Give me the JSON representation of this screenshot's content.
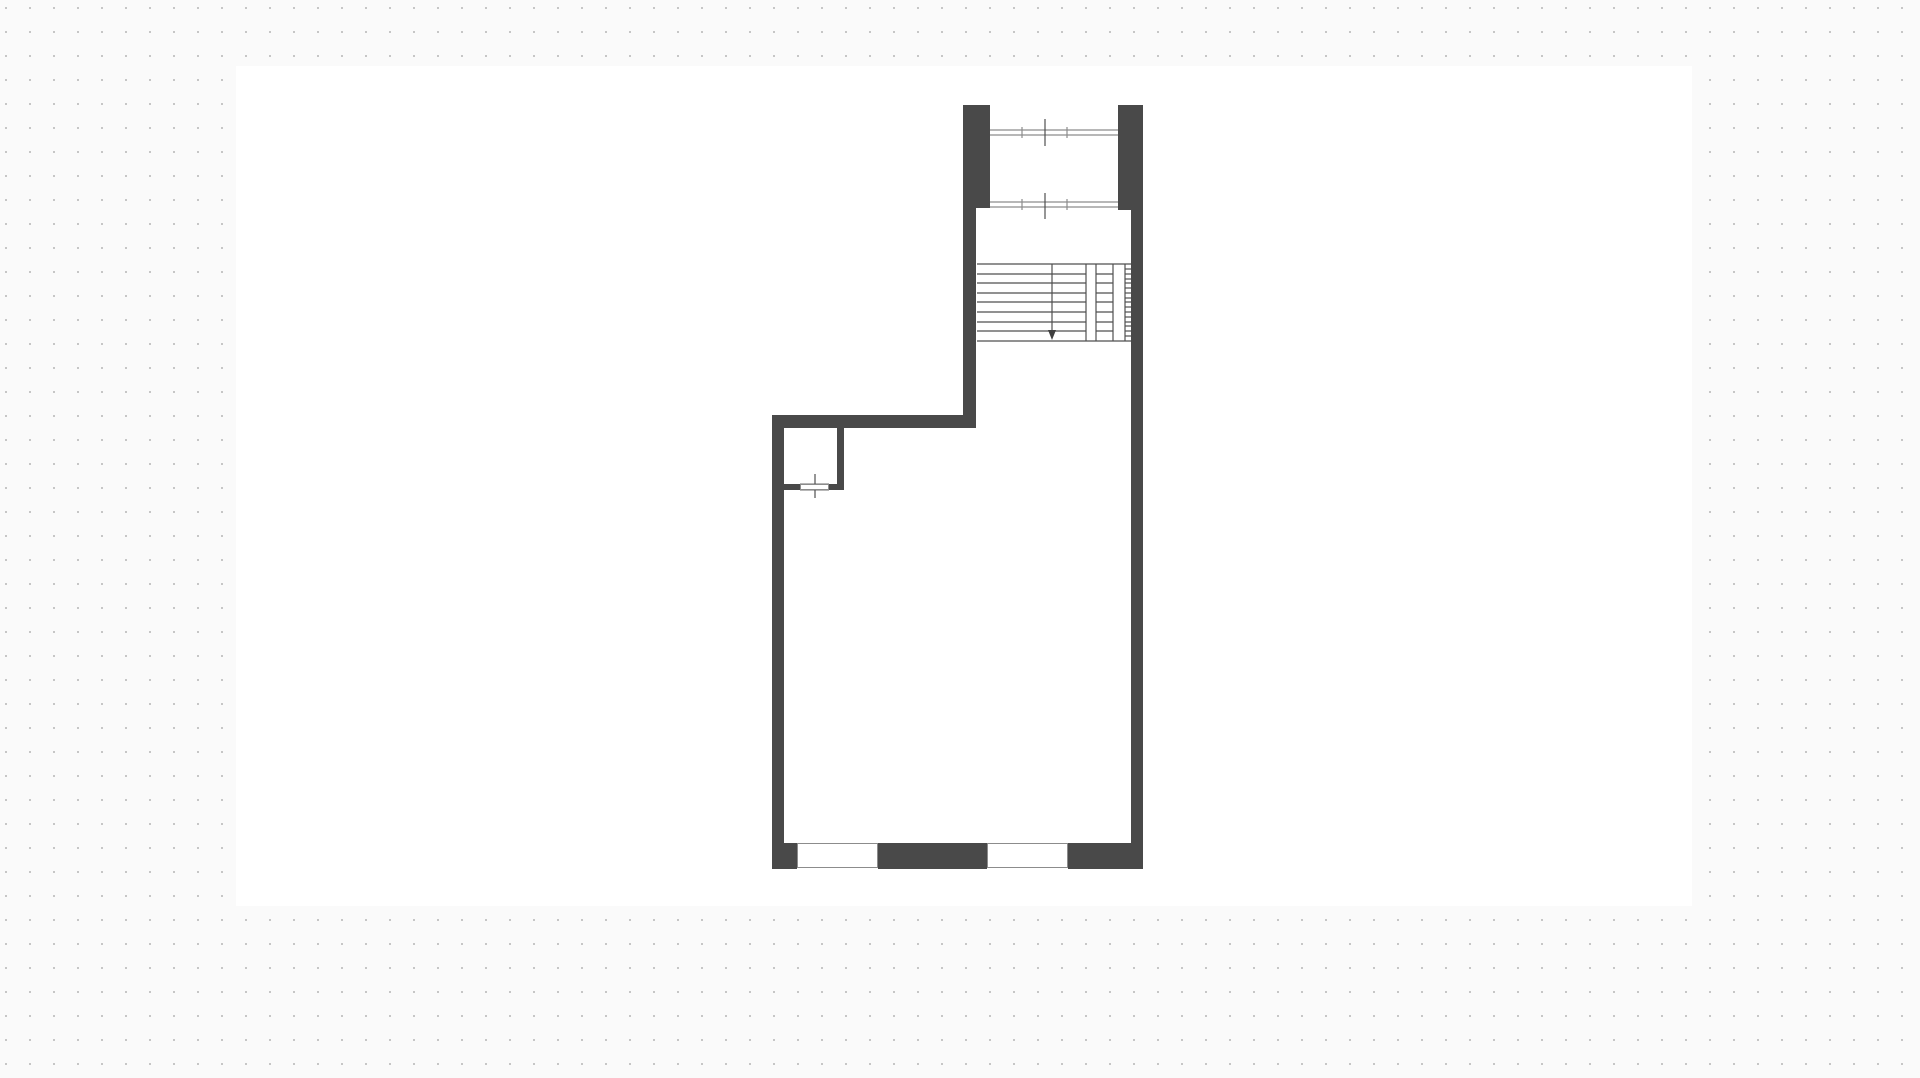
{
  "canvas": {
    "width": 1920,
    "height": 1078,
    "background_color": "#fafafa",
    "grid": {
      "spacing": 24,
      "dot_size": 2,
      "dot_color": "#c6c6c6",
      "offset_x": 5,
      "offset_y": 7
    },
    "artboard": {
      "x": 236,
      "y": 66,
      "width": 1456,
      "height": 840,
      "color": "#ffffff"
    }
  },
  "plan": {
    "colors": {
      "wall": "#494949",
      "line": "#4f4f4f",
      "window_line": "#8c8c8c",
      "window_fill": "#ffffff"
    },
    "walls": [
      {
        "name": "upper-pillar-left",
        "x": 963,
        "y": 105,
        "w": 27,
        "h": 103
      },
      {
        "name": "upper-pillar-right",
        "x": 1118,
        "y": 105,
        "w": 25,
        "h": 105
      },
      {
        "name": "stairwell-left-wall",
        "x": 963,
        "y": 205,
        "w": 13,
        "h": 223
      },
      {
        "name": "right-exterior-wall",
        "x": 1131,
        "y": 205,
        "w": 12,
        "h": 664
      },
      {
        "name": "room-top-wall",
        "x": 772,
        "y": 415,
        "w": 204,
        "h": 13
      },
      {
        "name": "left-exterior-wall",
        "x": 772,
        "y": 415,
        "w": 12,
        "h": 454
      },
      {
        "name": "bottom-wall-left",
        "x": 772,
        "y": 843,
        "w": 25,
        "h": 26
      },
      {
        "name": "bottom-wall-middle",
        "x": 878,
        "y": 843,
        "w": 109,
        "h": 26
      },
      {
        "name": "bottom-wall-right",
        "x": 1068,
        "y": 843,
        "w": 75,
        "h": 26
      },
      {
        "name": "closet-partition-wall",
        "x": 837,
        "y": 427,
        "w": 7,
        "h": 63
      },
      {
        "name": "closet-bottom-wall-a",
        "x": 784,
        "y": 484,
        "w": 16,
        "h": 6
      },
      {
        "name": "closet-bottom-wall-b",
        "x": 829,
        "y": 484,
        "w": 8,
        "h": 6
      }
    ],
    "windows": [
      {
        "name": "bottom-window-left",
        "x": 797,
        "y": 843,
        "w": 81,
        "h": 25
      },
      {
        "name": "bottom-window-right",
        "x": 987,
        "y": 843,
        "w": 81,
        "h": 25
      },
      {
        "name": "closet-door-opening",
        "x": 800,
        "y": 484,
        "w": 29,
        "h": 6
      }
    ],
    "lines": [
      {
        "name": "upper-window-1-line",
        "x1": 990,
        "y1": 130,
        "x2": 1118,
        "y2": 130,
        "color": "#8c8c8c"
      },
      {
        "name": "upper-window-1-line",
        "x1": 990,
        "y1": 135,
        "x2": 1118,
        "y2": 135,
        "color": "#8c8c8c"
      },
      {
        "name": "upper-window-1-mullion",
        "x1": 1022,
        "y1": 127,
        "x2": 1022,
        "y2": 138,
        "color": "#8c8c8c"
      },
      {
        "name": "upper-window-1-mullion",
        "x1": 1067,
        "y1": 127,
        "x2": 1067,
        "y2": 138,
        "color": "#8c8c8c"
      },
      {
        "name": "upper-window-1-center-mark",
        "x1": 1045,
        "y1": 119,
        "x2": 1045,
        "y2": 146,
        "color": "#4f4f4f"
      },
      {
        "name": "upper-window-2-line",
        "x1": 990,
        "y1": 202,
        "x2": 1118,
        "y2": 202,
        "color": "#8c8c8c"
      },
      {
        "name": "upper-window-2-line",
        "x1": 990,
        "y1": 207,
        "x2": 1118,
        "y2": 207,
        "color": "#8c8c8c"
      },
      {
        "name": "upper-window-2-mullion",
        "x1": 1022,
        "y1": 199,
        "x2": 1022,
        "y2": 210,
        "color": "#8c8c8c"
      },
      {
        "name": "upper-window-2-mullion",
        "x1": 1067,
        "y1": 199,
        "x2": 1067,
        "y2": 210,
        "color": "#8c8c8c"
      },
      {
        "name": "upper-window-2-center-mark",
        "x1": 1045,
        "y1": 193,
        "x2": 1045,
        "y2": 219,
        "color": "#4f4f4f"
      },
      {
        "name": "stair-top-edge",
        "x1": 977,
        "y1": 264,
        "x2": 1131,
        "y2": 264,
        "color": "#4f4f4f"
      },
      {
        "name": "stair-bottom-edge",
        "x1": 977,
        "y1": 341,
        "x2": 1131,
        "y2": 341,
        "color": "#4f4f4f"
      },
      {
        "name": "stair-tread",
        "x1": 977,
        "y1": 274,
        "x2": 1086,
        "y2": 274,
        "color": "#4f4f4f"
      },
      {
        "name": "stair-tread",
        "x1": 977,
        "y1": 283,
        "x2": 1086,
        "y2": 283,
        "color": "#4f4f4f"
      },
      {
        "name": "stair-tread",
        "x1": 977,
        "y1": 293,
        "x2": 1086,
        "y2": 293,
        "color": "#4f4f4f"
      },
      {
        "name": "stair-tread",
        "x1": 977,
        "y1": 302,
        "x2": 1086,
        "y2": 302,
        "color": "#4f4f4f"
      },
      {
        "name": "stair-tread",
        "x1": 977,
        "y1": 312,
        "x2": 1086,
        "y2": 312,
        "color": "#4f4f4f"
      },
      {
        "name": "stair-tread",
        "x1": 977,
        "y1": 322,
        "x2": 1086,
        "y2": 322,
        "color": "#4f4f4f"
      },
      {
        "name": "stair-tread",
        "x1": 977,
        "y1": 331,
        "x2": 1086,
        "y2": 331,
        "color": "#4f4f4f"
      },
      {
        "name": "stair-flight-divider",
        "x1": 1086,
        "y1": 264,
        "x2": 1086,
        "y2": 341,
        "color": "#4f4f4f"
      },
      {
        "name": "stair-flight-divider",
        "x1": 1096,
        "y1": 264,
        "x2": 1096,
        "y2": 341,
        "color": "#4f4f4f"
      },
      {
        "name": "stair-flight-divider",
        "x1": 1113,
        "y1": 264,
        "x2": 1113,
        "y2": 341,
        "color": "#4f4f4f"
      },
      {
        "name": "stair-flight-divider",
        "x1": 1125,
        "y1": 264,
        "x2": 1125,
        "y2": 341,
        "color": "#4f4f4f"
      },
      {
        "name": "stair-tread-upper-flight",
        "x1": 1096,
        "y1": 274,
        "x2": 1113,
        "y2": 274,
        "color": "#4f4f4f"
      },
      {
        "name": "stair-tread-upper-flight",
        "x1": 1096,
        "y1": 283,
        "x2": 1113,
        "y2": 283,
        "color": "#4f4f4f"
      },
      {
        "name": "stair-tread-upper-flight",
        "x1": 1096,
        "y1": 293,
        "x2": 1113,
        "y2": 293,
        "color": "#4f4f4f"
      },
      {
        "name": "stair-tread-upper-flight",
        "x1": 1096,
        "y1": 302,
        "x2": 1113,
        "y2": 302,
        "color": "#4f4f4f"
      },
      {
        "name": "stair-tread-upper-flight",
        "x1": 1096,
        "y1": 312,
        "x2": 1113,
        "y2": 312,
        "color": "#4f4f4f"
      },
      {
        "name": "stair-tread-upper-flight",
        "x1": 1096,
        "y1": 322,
        "x2": 1113,
        "y2": 322,
        "color": "#4f4f4f"
      },
      {
        "name": "stair-tread-upper-flight",
        "x1": 1096,
        "y1": 331,
        "x2": 1113,
        "y2": 331,
        "color": "#4f4f4f"
      },
      {
        "name": "stair-tread-narrow",
        "x1": 1125,
        "y1": 269,
        "x2": 1131,
        "y2": 269,
        "color": "#4f4f4f"
      },
      {
        "name": "stair-tread-narrow",
        "x1": 1125,
        "y1": 274,
        "x2": 1131,
        "y2": 274,
        "color": "#4f4f4f"
      },
      {
        "name": "stair-tread-narrow",
        "x1": 1125,
        "y1": 279,
        "x2": 1131,
        "y2": 279,
        "color": "#4f4f4f"
      },
      {
        "name": "stair-tread-narrow",
        "x1": 1125,
        "y1": 283,
        "x2": 1131,
        "y2": 283,
        "color": "#4f4f4f"
      },
      {
        "name": "stair-tread-narrow",
        "x1": 1125,
        "y1": 288,
        "x2": 1131,
        "y2": 288,
        "color": "#4f4f4f"
      },
      {
        "name": "stair-tread-narrow",
        "x1": 1125,
        "y1": 293,
        "x2": 1131,
        "y2": 293,
        "color": "#4f4f4f"
      },
      {
        "name": "stair-tread-narrow",
        "x1": 1125,
        "y1": 298,
        "x2": 1131,
        "y2": 298,
        "color": "#4f4f4f"
      },
      {
        "name": "stair-tread-narrow",
        "x1": 1125,
        "y1": 302,
        "x2": 1131,
        "y2": 302,
        "color": "#4f4f4f"
      },
      {
        "name": "stair-tread-narrow",
        "x1": 1125,
        "y1": 307,
        "x2": 1131,
        "y2": 307,
        "color": "#4f4f4f"
      },
      {
        "name": "stair-tread-narrow",
        "x1": 1125,
        "y1": 312,
        "x2": 1131,
        "y2": 312,
        "color": "#4f4f4f"
      },
      {
        "name": "stair-tread-narrow",
        "x1": 1125,
        "y1": 317,
        "x2": 1131,
        "y2": 317,
        "color": "#4f4f4f"
      },
      {
        "name": "stair-tread-narrow",
        "x1": 1125,
        "y1": 322,
        "x2": 1131,
        "y2": 322,
        "color": "#4f4f4f"
      },
      {
        "name": "stair-tread-narrow",
        "x1": 1125,
        "y1": 326,
        "x2": 1131,
        "y2": 326,
        "color": "#4f4f4f"
      },
      {
        "name": "stair-tread-narrow",
        "x1": 1125,
        "y1": 331,
        "x2": 1131,
        "y2": 331,
        "color": "#4f4f4f"
      },
      {
        "name": "stair-tread-narrow",
        "x1": 1125,
        "y1": 336,
        "x2": 1131,
        "y2": 336,
        "color": "#4f4f4f"
      },
      {
        "name": "stair-walk-line",
        "x1": 1052,
        "y1": 264,
        "x2": 1052,
        "y2": 331,
        "color": "#4f4f4f"
      },
      {
        "name": "closet-door-line",
        "x1": 800,
        "y1": 484,
        "x2": 829,
        "y2": 484,
        "color": "#8c8c8c"
      },
      {
        "name": "closet-door-line",
        "x1": 800,
        "y1": 490,
        "x2": 829,
        "y2": 490,
        "color": "#8c8c8c"
      },
      {
        "name": "closet-door-center-mark",
        "x1": 815,
        "y1": 474,
        "x2": 815,
        "y2": 498,
        "color": "#4f4f4f"
      }
    ],
    "arrow": {
      "name": "stair-direction-arrow",
      "points": "1048,330 1056,330 1052,340",
      "color": "#3f3f3f"
    }
  }
}
